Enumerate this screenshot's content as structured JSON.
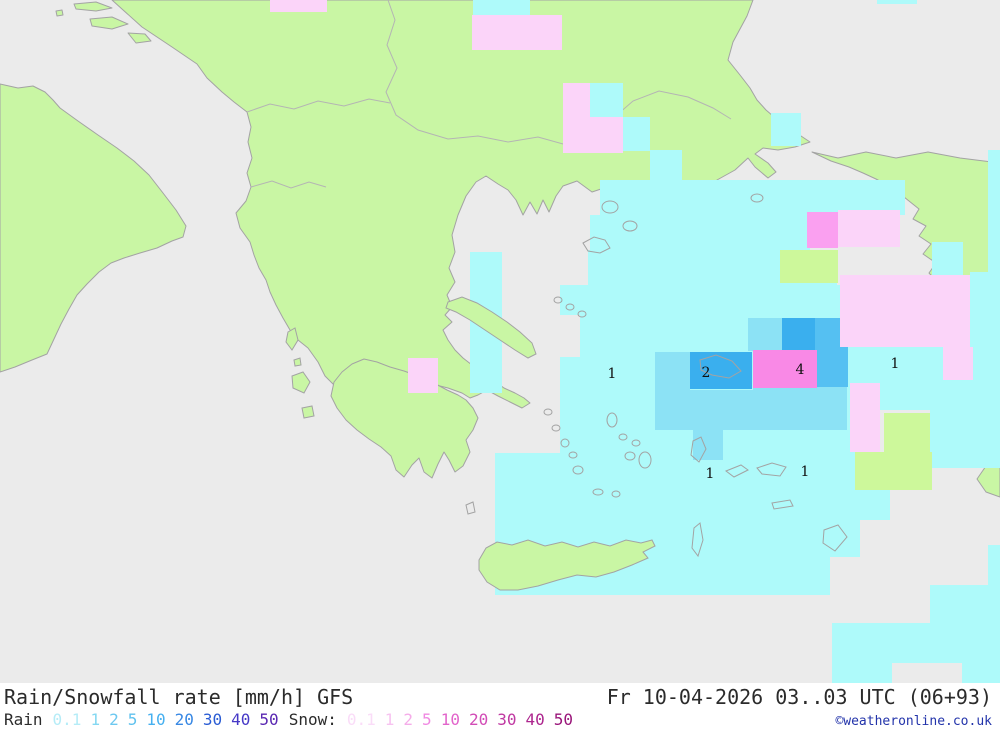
{
  "colors": {
    "sea": "#ebebeb",
    "land": "#c9f6a4",
    "coast": "#a3a3a3",
    "border": "#b4b4b4",
    "precip_trace": "#aefafa",
    "precip_light": "#8ce2f5",
    "precip_moderate": "#55c0f2",
    "precip_heavy": "#3aafee",
    "snow_light": "#fbd4f9",
    "snow_moderate": "#faa0f0",
    "snow_heavy": "#f989e6",
    "precip_green": "#cdf89b",
    "label": "#111111",
    "title_text": "#2b2b2b",
    "copyright": "#2233aa"
  },
  "map": {
    "value_labels": [
      {
        "text": "1",
        "x": 612,
        "y": 378
      },
      {
        "text": "2",
        "x": 706,
        "y": 377
      },
      {
        "text": "4",
        "x": 800,
        "y": 374
      },
      {
        "text": "1",
        "x": 895,
        "y": 368
      },
      {
        "text": "1",
        "x": 710,
        "y": 478
      },
      {
        "text": "1",
        "x": 805,
        "y": 476
      }
    ]
  },
  "footer": {
    "title": "Rain/Snowfall rate [mm/h] GFS",
    "datetime": "Fr 10-04-2026 03..03 UTC (06+93)",
    "copyright": "©weatheronline.co.uk",
    "rain_label": "Rain",
    "snow_label": "Snow:",
    "rain_scale": [
      {
        "value": "0.1",
        "color": "#b5ecf7"
      },
      {
        "value": "1",
        "color": "#84d8f2"
      },
      {
        "value": "2",
        "color": "#6cc8f0"
      },
      {
        "value": "5",
        "color": "#60c2ee"
      },
      {
        "value": "10",
        "color": "#46b0f0"
      },
      {
        "value": "20",
        "color": "#3888e4"
      },
      {
        "value": "30",
        "color": "#2a5cd4"
      },
      {
        "value": "40",
        "color": "#4538c6"
      },
      {
        "value": "50",
        "color": "#5a28b2"
      }
    ],
    "snow_scale": [
      {
        "value": "0.1",
        "color": "#fadcf8"
      },
      {
        "value": "1",
        "color": "#f7c2f0"
      },
      {
        "value": "2",
        "color": "#f5ace9"
      },
      {
        "value": "5",
        "color": "#f089e2"
      },
      {
        "value": "10",
        "color": "#e264cb"
      },
      {
        "value": "20",
        "color": "#d24cb6"
      },
      {
        "value": "30",
        "color": "#c038a2"
      },
      {
        "value": "40",
        "color": "#ad268e"
      },
      {
        "value": "50",
        "color": "#9a167a"
      }
    ]
  }
}
